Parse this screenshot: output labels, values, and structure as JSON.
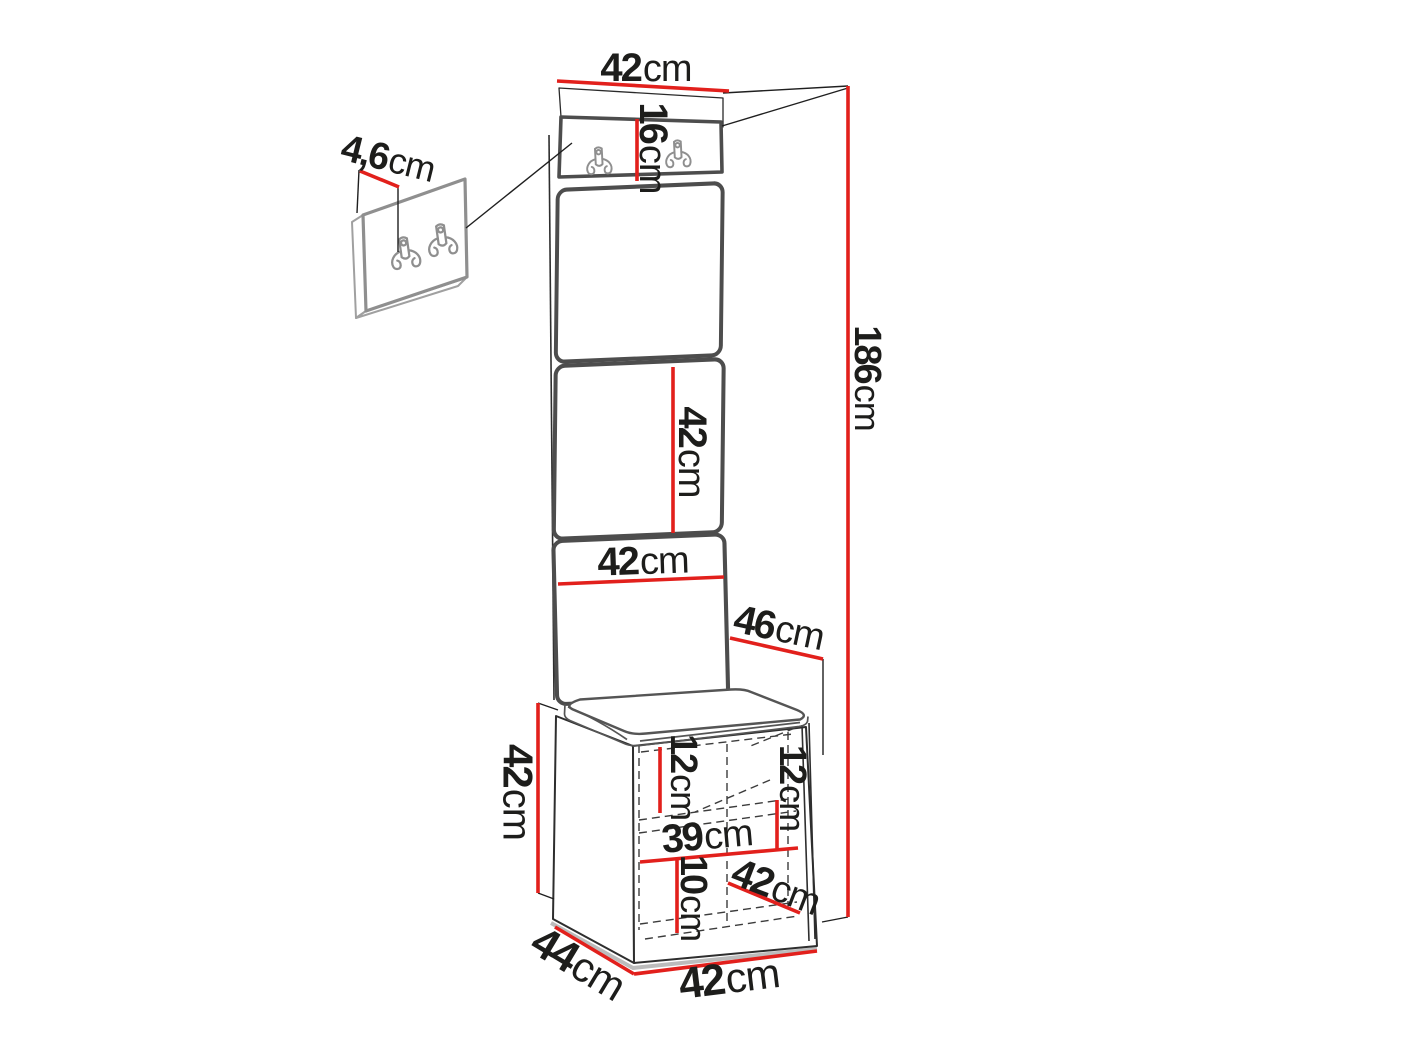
{
  "diagram": {
    "type": "furniture-dimension-drawing",
    "subject": "hallway set: wall panel with coat hooks and shoe bench",
    "unit": "cm",
    "colors": {
      "background": "#ffffff",
      "dimension": "#e2201c",
      "outline": "#4d4d4d",
      "line": "#1f1f1f",
      "text": "#1d1d1b"
    },
    "icons": {
      "double_hook": "double-coat-hook-icon"
    },
    "labels": [
      {
        "id": "top-width",
        "value": "42",
        "unit": "cm"
      },
      {
        "id": "hook-panel-depth",
        "value": "4,6",
        "unit": "cm"
      },
      {
        "id": "hook-strip-height",
        "value": "16",
        "unit": "cm"
      },
      {
        "id": "total-height",
        "value": "186",
        "unit": "cm"
      },
      {
        "id": "panel-segment-height",
        "value": "42",
        "unit": "cm"
      },
      {
        "id": "panel-width",
        "value": "42",
        "unit": "cm"
      },
      {
        "id": "seat-depth",
        "value": "46",
        "unit": "cm"
      },
      {
        "id": "bench-height",
        "value": "42",
        "unit": "cm"
      },
      {
        "id": "shelf-left-height",
        "value": "12",
        "unit": "cm"
      },
      {
        "id": "shelf-right-height",
        "value": "12",
        "unit": "cm"
      },
      {
        "id": "inner-width",
        "value": "39",
        "unit": "cm"
      },
      {
        "id": "bottom-shelf-height",
        "value": "10",
        "unit": "cm"
      },
      {
        "id": "bench-inner-diagonal",
        "value": "42",
        "unit": "cm"
      },
      {
        "id": "bench-depth",
        "value": "44",
        "unit": "cm"
      },
      {
        "id": "bench-width",
        "value": "42",
        "unit": "cm"
      }
    ]
  }
}
